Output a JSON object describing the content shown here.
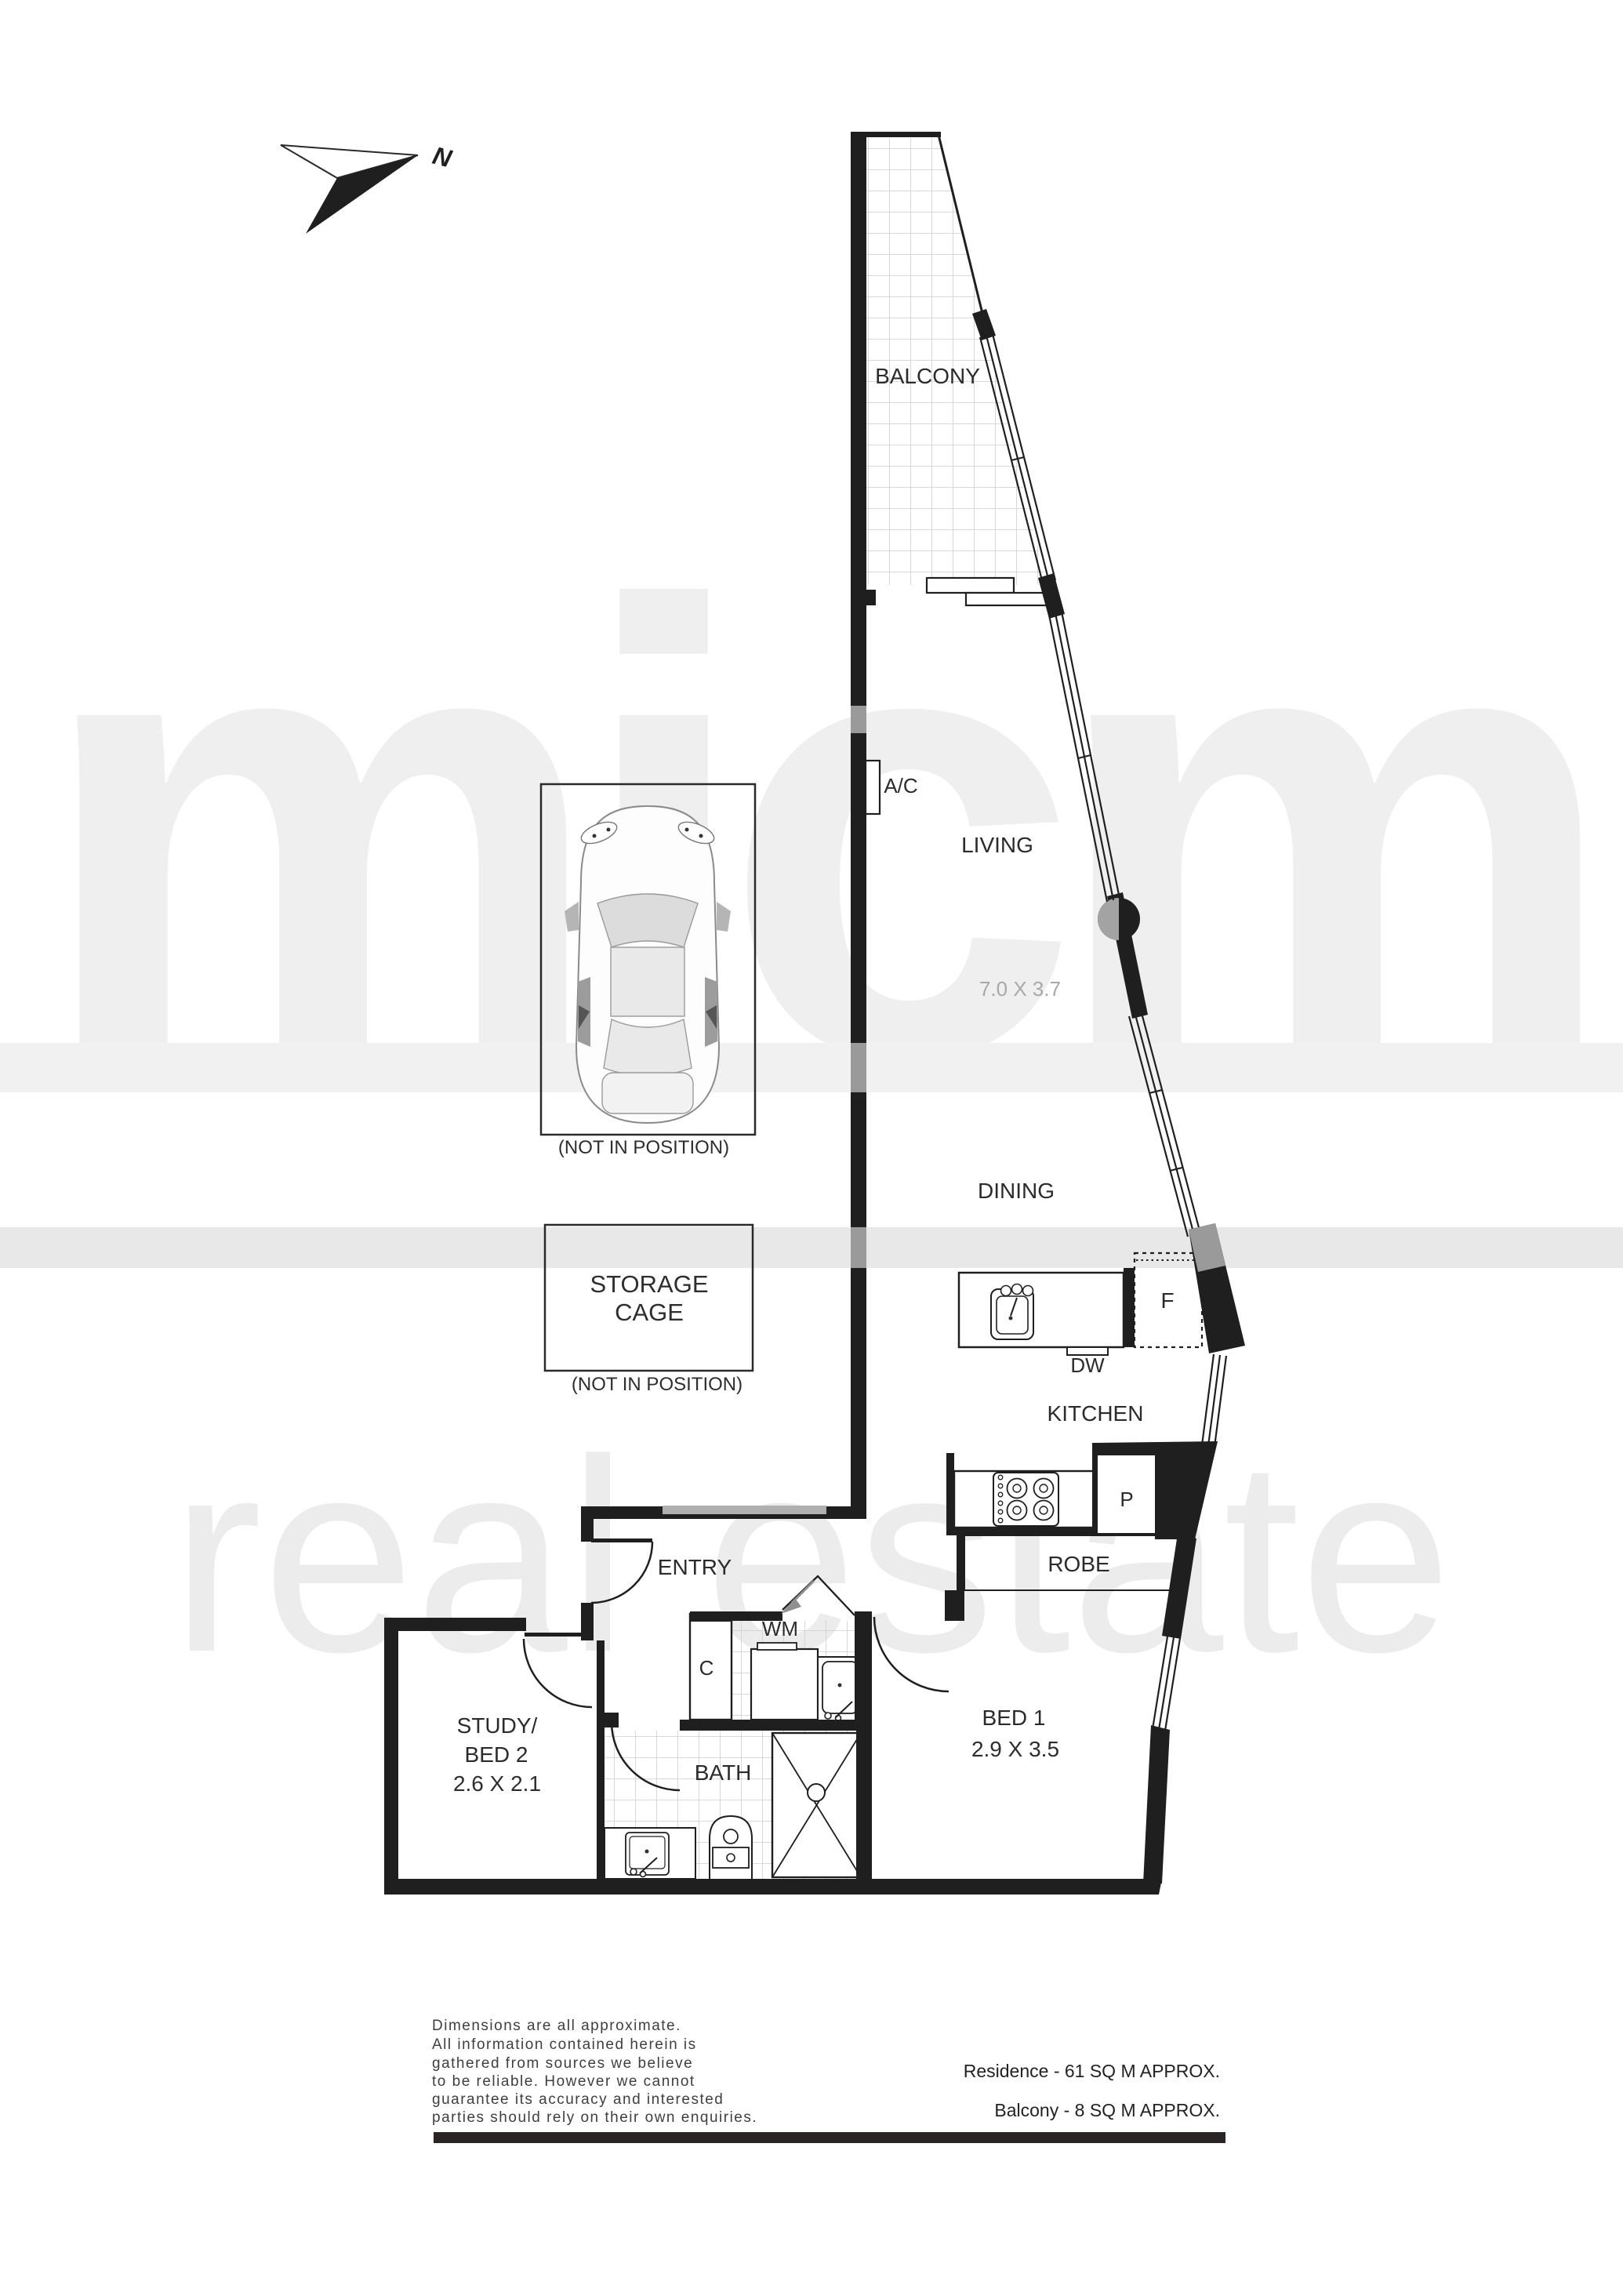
{
  "title": "Apartment floor plan",
  "north": {
    "label": "N"
  },
  "rooms": {
    "balcony": {
      "label": "BALCONY"
    },
    "living": {
      "label": "LIVING",
      "dims": "7.0 X 3.7"
    },
    "dining": {
      "label": "DINING"
    },
    "kitchen": {
      "label": "KITCHEN"
    },
    "entry": {
      "label": "ENTRY"
    },
    "bath": {
      "label": "BATH"
    },
    "bed1": {
      "label": "BED 1",
      "dims": "2.9 X 3.5"
    },
    "study": {
      "label_line1": "STUDY/",
      "label_line2": "BED 2",
      "dims": "2.6 X 2.1"
    },
    "robe": {
      "label": "ROBE"
    }
  },
  "fixtures": {
    "ac": "A/C",
    "dw": "DW",
    "fridge": "F",
    "pantry": "P",
    "wm": "WM",
    "cupboard": "C"
  },
  "annotations": {
    "storage_line1": "STORAGE",
    "storage_line2": "CAGE",
    "storage_note": "(NOT IN POSITION)",
    "car_note": "(NOT IN POSITION)"
  },
  "watermark": {
    "brand": "micm",
    "tagline": "real estate"
  },
  "footer": {
    "disclaimer_lines": [
      "Dimensions are all approximate.",
      "All information contained herein is",
      "gathered from sources we believe",
      "to be reliable. However we cannot",
      "guarantee its accuracy and interested",
      "parties should rely on their own enquiries."
    ],
    "residence_area": "Residence - 61 SQ M APPROX.",
    "balcony_area": "Balcony - 8 SQ M APPROX."
  },
  "colors": {
    "wall": "#1f1f1f",
    "tile_line": "#d4d4d4",
    "watermark_brand": "#efefef",
    "watermark_tagline": "#ececec",
    "band": "#e8e8e8",
    "gray_overlay": "#9a9a9a",
    "dim_text": "#a8a8a8"
  }
}
